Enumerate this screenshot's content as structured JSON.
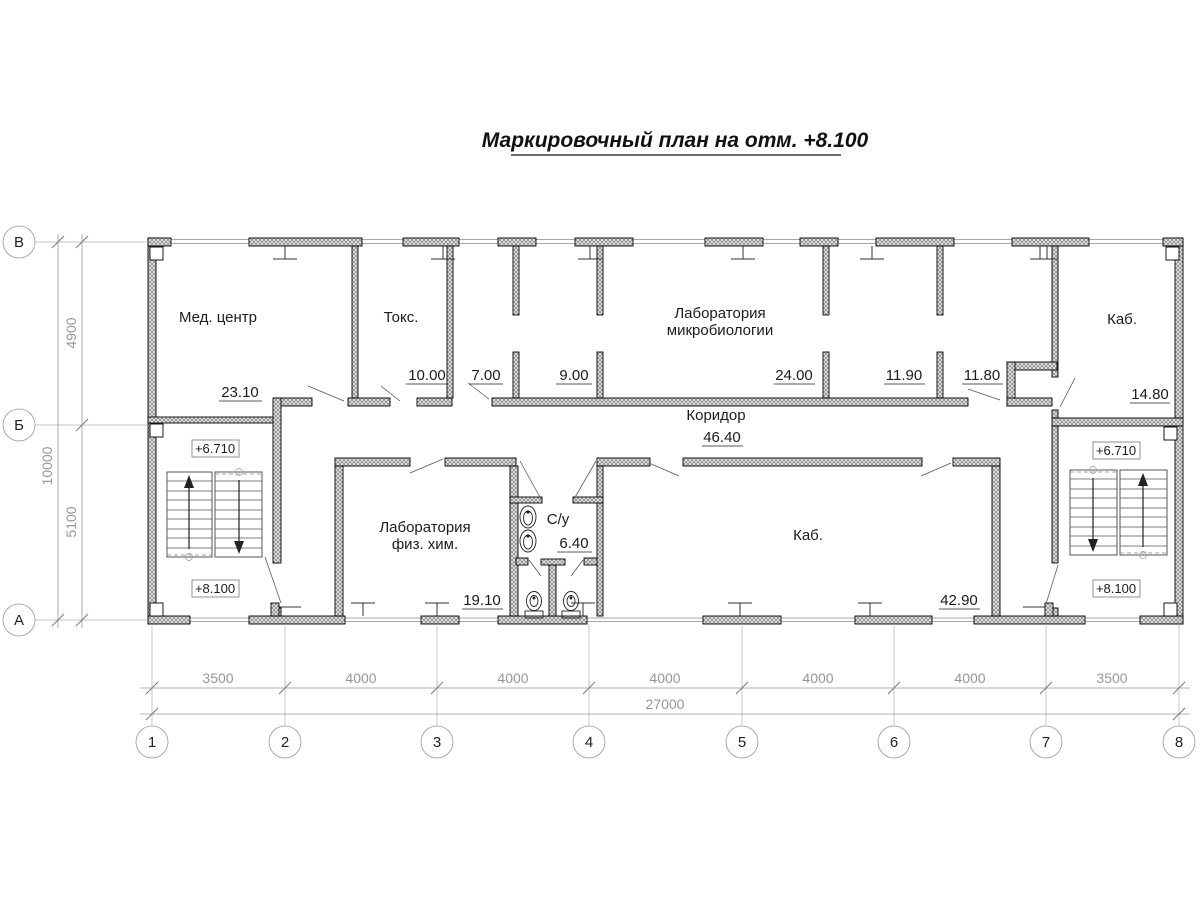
{
  "title": "Маркировочный план на отм. +8.100",
  "rooms": {
    "med_center": {
      "label": "Мед. центр",
      "area": "23.10"
    },
    "toks": {
      "label": "Токс.",
      "area": "10.00"
    },
    "room7": {
      "area": "7.00"
    },
    "room9": {
      "area": "9.00"
    },
    "lab_micro": {
      "label_line1": "Лаборатория",
      "label_line2": "микробиологии",
      "area": "24.00"
    },
    "room119": {
      "area": "11.90"
    },
    "room118": {
      "area": "11.80"
    },
    "kab_small": {
      "label": "Каб.",
      "area": "14.80"
    },
    "corridor": {
      "label": "Коридор",
      "area": "46.40"
    },
    "lab_chem": {
      "label_line1": "Лаборатория",
      "label_line2": "физ. хим.",
      "area": "19.10"
    },
    "sanitary": {
      "label": "С/у",
      "area": "6.40"
    },
    "kab_large": {
      "label": "Каб.",
      "area": "42.90"
    }
  },
  "elevations": {
    "stair_left_upper": "+6.710",
    "stair_left_lower": "+8.100",
    "stair_right_upper": "+6.710",
    "stair_right_lower": "+8.100"
  },
  "axes": {
    "columns": [
      "1",
      "2",
      "3",
      "4",
      "5",
      "6",
      "7",
      "8"
    ],
    "rows": [
      "В",
      "Б",
      "А"
    ]
  },
  "dimensions": {
    "bottom_segments": [
      "3500",
      "4000",
      "4000",
      "4000",
      "4000",
      "4000",
      "3500"
    ],
    "bottom_total": "27000",
    "left_segments": [
      "4900",
      "5100"
    ],
    "left_total": "10000"
  }
}
